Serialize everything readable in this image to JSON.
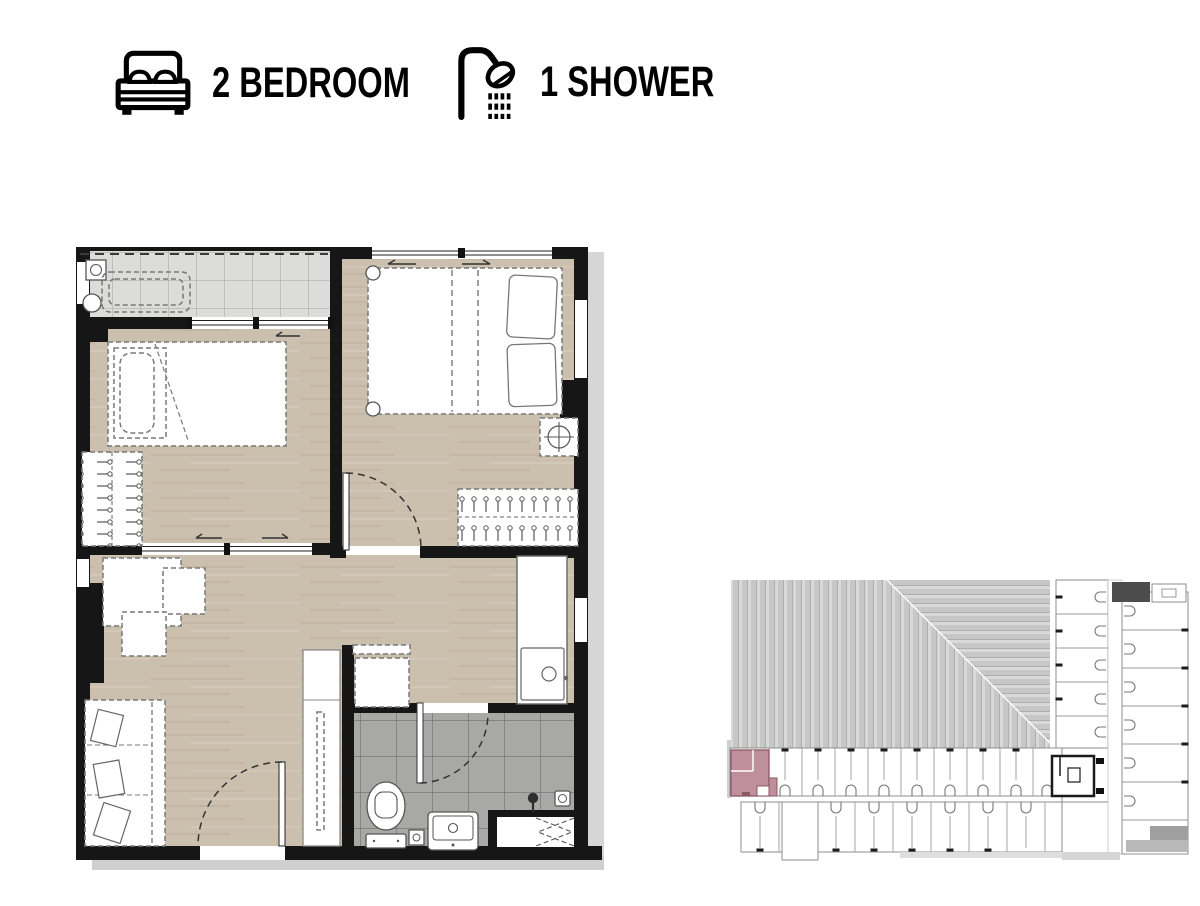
{
  "header": {
    "bedrooms": {
      "icon": "bed-icon",
      "label": "2 BEDROOM"
    },
    "showers": {
      "icon": "shower-icon",
      "label": "1 SHOWER"
    }
  },
  "floor_plan": {
    "type": "2-bedroom-unit-plan",
    "rooms": [
      {
        "name": "balcony",
        "floor": "light-gray-tile"
      },
      {
        "name": "bedroom-2",
        "floor": "wood"
      },
      {
        "name": "master-bedroom",
        "floor": "wood"
      },
      {
        "name": "living-dining",
        "floor": "wood"
      },
      {
        "name": "kitchen",
        "floor": "wood"
      },
      {
        "name": "bathroom",
        "floor": "gray-tile"
      }
    ],
    "fixtures": [
      "double-bed",
      "single-bed",
      "wardrobe",
      "sofa",
      "desk",
      "dining-table",
      "kitchen-counter-sink",
      "tall-cabinet",
      "toilet",
      "vanity-basin",
      "shower-head",
      "floor-drain",
      "washer-area",
      "ac-ledge",
      "condensing-unit"
    ],
    "colors": {
      "wall": "#161616",
      "wood_floor": "#cbbfae",
      "balcony_tile": "#dcdcda",
      "bathroom_tile": "#a8a8a6",
      "furniture_line": "#787878"
    }
  },
  "key_plan": {
    "name": "building-floor-plate",
    "highlighted_unit": "2-bedroom-corner-unit",
    "colors": {
      "highlight": "#c08f9c",
      "highlight_line": "#8a5a66",
      "lines": "#8e8e8e",
      "dark_block": "#4c4c4c",
      "stripe_light": "#d9d9d9",
      "stripe_dark": "#c7c7c7"
    }
  }
}
